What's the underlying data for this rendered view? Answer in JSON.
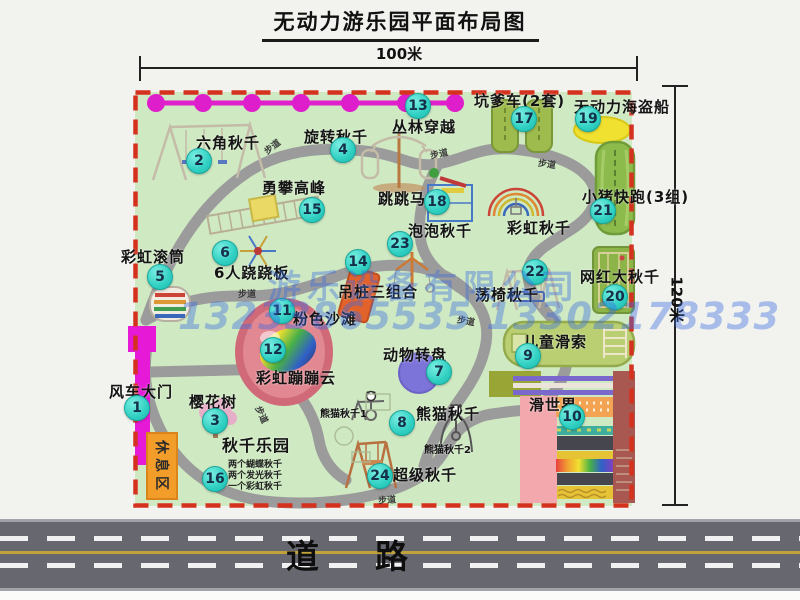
{
  "title": "无动力游乐园平面布局图",
  "dimensions": {
    "top": "100米",
    "right": "120米"
  },
  "watermark": {
    "company": "游乐设备有限公司",
    "phones": "13233865535 13302178333"
  },
  "road": {
    "label": "道路"
  },
  "rest_area_label": "休息区",
  "trail_label": "步道",
  "extra_labels": {
    "rainbow_swing": "彩虹秋千",
    "panda_swing_1": "熊猫秋千1",
    "panda_swing_2": "熊猫秋千2"
  },
  "attractions": [
    {
      "num": "1",
      "label": "风车大门"
    },
    {
      "num": "2",
      "label": "六角秋千"
    },
    {
      "num": "3",
      "label": "樱花树"
    },
    {
      "num": "4",
      "label": "旋转秋千"
    },
    {
      "num": "5",
      "label": "彩虹滚筒"
    },
    {
      "num": "6",
      "label": "6人跷跷板"
    },
    {
      "num": "7",
      "label": "动物转盘"
    },
    {
      "num": "8",
      "label": "熊猫秋千"
    },
    {
      "num": "9",
      "label": "儿童滑索"
    },
    {
      "num": "10",
      "label": "滑世界"
    },
    {
      "num": "11",
      "label": "粉色沙滩"
    },
    {
      "num": "12",
      "label": "彩虹蹦蹦云"
    },
    {
      "num": "13",
      "label": "丛林穿越"
    },
    {
      "num": "14",
      "label": "吊桩三组合"
    },
    {
      "num": "15",
      "label": "勇攀高峰"
    },
    {
      "num": "16",
      "label": "秋千乐园",
      "notes": [
        "两个蝴蝶秋千",
        "两个发光秋千",
        "一个彩虹秋千"
      ]
    },
    {
      "num": "17",
      "label": "坑爹车(2套)"
    },
    {
      "num": "18",
      "label": "跳跳马"
    },
    {
      "num": "19",
      "label": "无动力海盗船"
    },
    {
      "num": "20",
      "label": "网红大秋千"
    },
    {
      "num": "21",
      "label": "小猪快跑(3组)"
    },
    {
      "num": "22",
      "label": "荡椅秋千"
    },
    {
      "num": "23",
      "label": "泡泡秋千"
    },
    {
      "num": "24",
      "label": "超级秋千"
    }
  ],
  "colors": {
    "park_green": "#cfe9c2",
    "border_red": "#d5311f",
    "badge_teal": "#2fd0c2",
    "zipline_magenta": "#e020cc",
    "gate_magenta": "#e619d6",
    "rest_area_orange": "#f29d2a",
    "road_gray": "#67676f",
    "watermark_blue": "#3a6ce0"
  }
}
